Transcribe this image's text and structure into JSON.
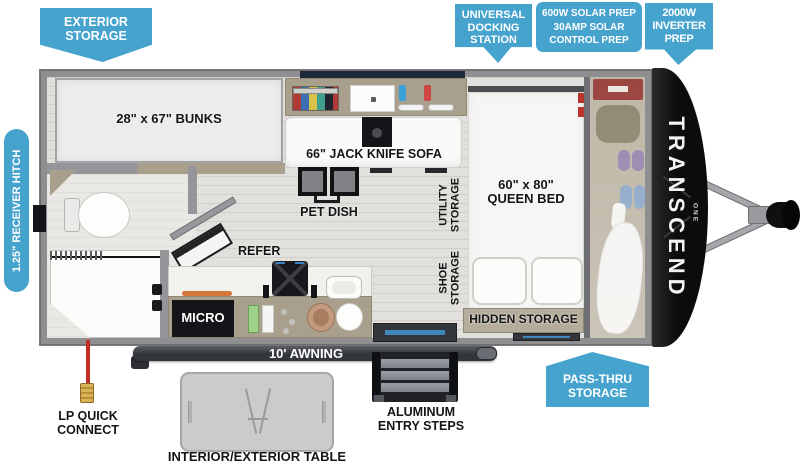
{
  "callouts": {
    "exterior_storage": {
      "line1": "EXTERIOR",
      "line2": "STORAGE"
    },
    "docking": {
      "line1": "UNIVERSAL",
      "line2": "DOCKING",
      "line3": "STATION"
    },
    "solar": {
      "line1": "600W SOLAR PREP",
      "line2": "30AMP SOLAR",
      "line3": "CONTROL PREP"
    },
    "inverter": {
      "line1": "2000W",
      "line2": "INVERTER",
      "line3": "PREP"
    },
    "pass_thru": {
      "line1": "PASS-THRU",
      "line2": "STORAGE"
    },
    "receiver_hitch": {
      "label": "1.25\" RECEIVER HITCH"
    }
  },
  "interior": {
    "bunks": "28\" x 67\" BUNKS",
    "sofa": "66\" JACK KNIFE SOFA",
    "pet_dish": "PET DISH",
    "utility": {
      "line1": "UTILITY",
      "line2": "STORAGE"
    },
    "shoe": {
      "line1": "SHOE",
      "line2": "STORAGE"
    },
    "bed": {
      "line1": "60\" x 80\"",
      "line2": "QUEEN BED"
    },
    "hidden_storage": "HIDDEN STORAGE",
    "refer": "REFER",
    "micro": "MICRO"
  },
  "exterior": {
    "awning": "10' AWNING",
    "lp": {
      "line1": "LP QUICK",
      "line2": "CONNECT"
    },
    "table": "INTERIOR/EXTERIOR TABLE",
    "steps": {
      "line1": "ALUMINUM",
      "line2": "ENTRY STEPS"
    },
    "brand": "TRANSCEND",
    "brand_sub": "ONE"
  },
  "colors": {
    "callout_blue": "#45a3ce",
    "wall_gray": "#8f8f92",
    "cabinet_tan": "#a89f8d",
    "hidden_storage_tan": "#b5ad9b",
    "cap_black": "#0c0c0e",
    "awning_dark": "#33363b",
    "lp_red": "#c43026",
    "mat_blue": "#3f86bb"
  }
}
